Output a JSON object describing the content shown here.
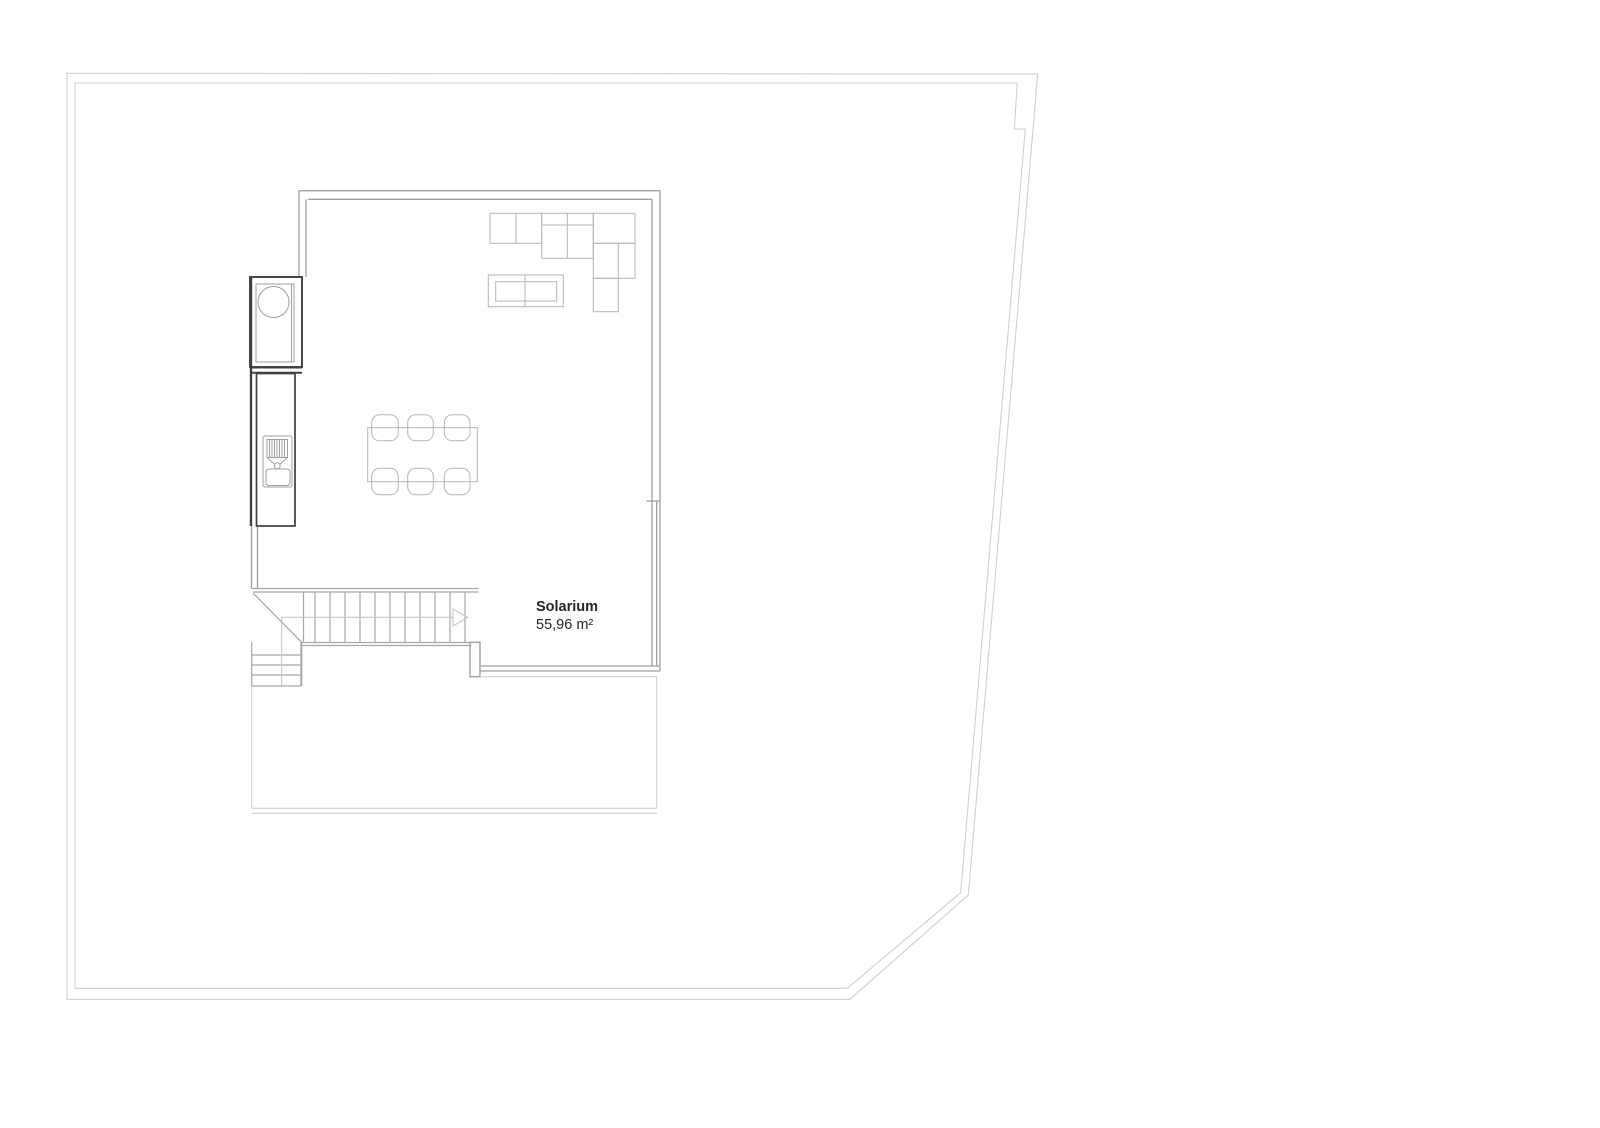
{
  "plan": {
    "room": {
      "name": "Solarium",
      "area": "55,96 m²"
    },
    "colors": {
      "boundary": "#cdd0d3",
      "wall": "#9aa0a3",
      "wall_light": "#b8bcbe",
      "furniture": "#b3b6b8",
      "stairs": "#a3a7a9",
      "walkline": "#c4c7c9",
      "kitchen_dark": "#3c4043",
      "kitchen_detail": "#9ba0a2",
      "terrace": "#c9cccd",
      "text": "#262626"
    }
  }
}
